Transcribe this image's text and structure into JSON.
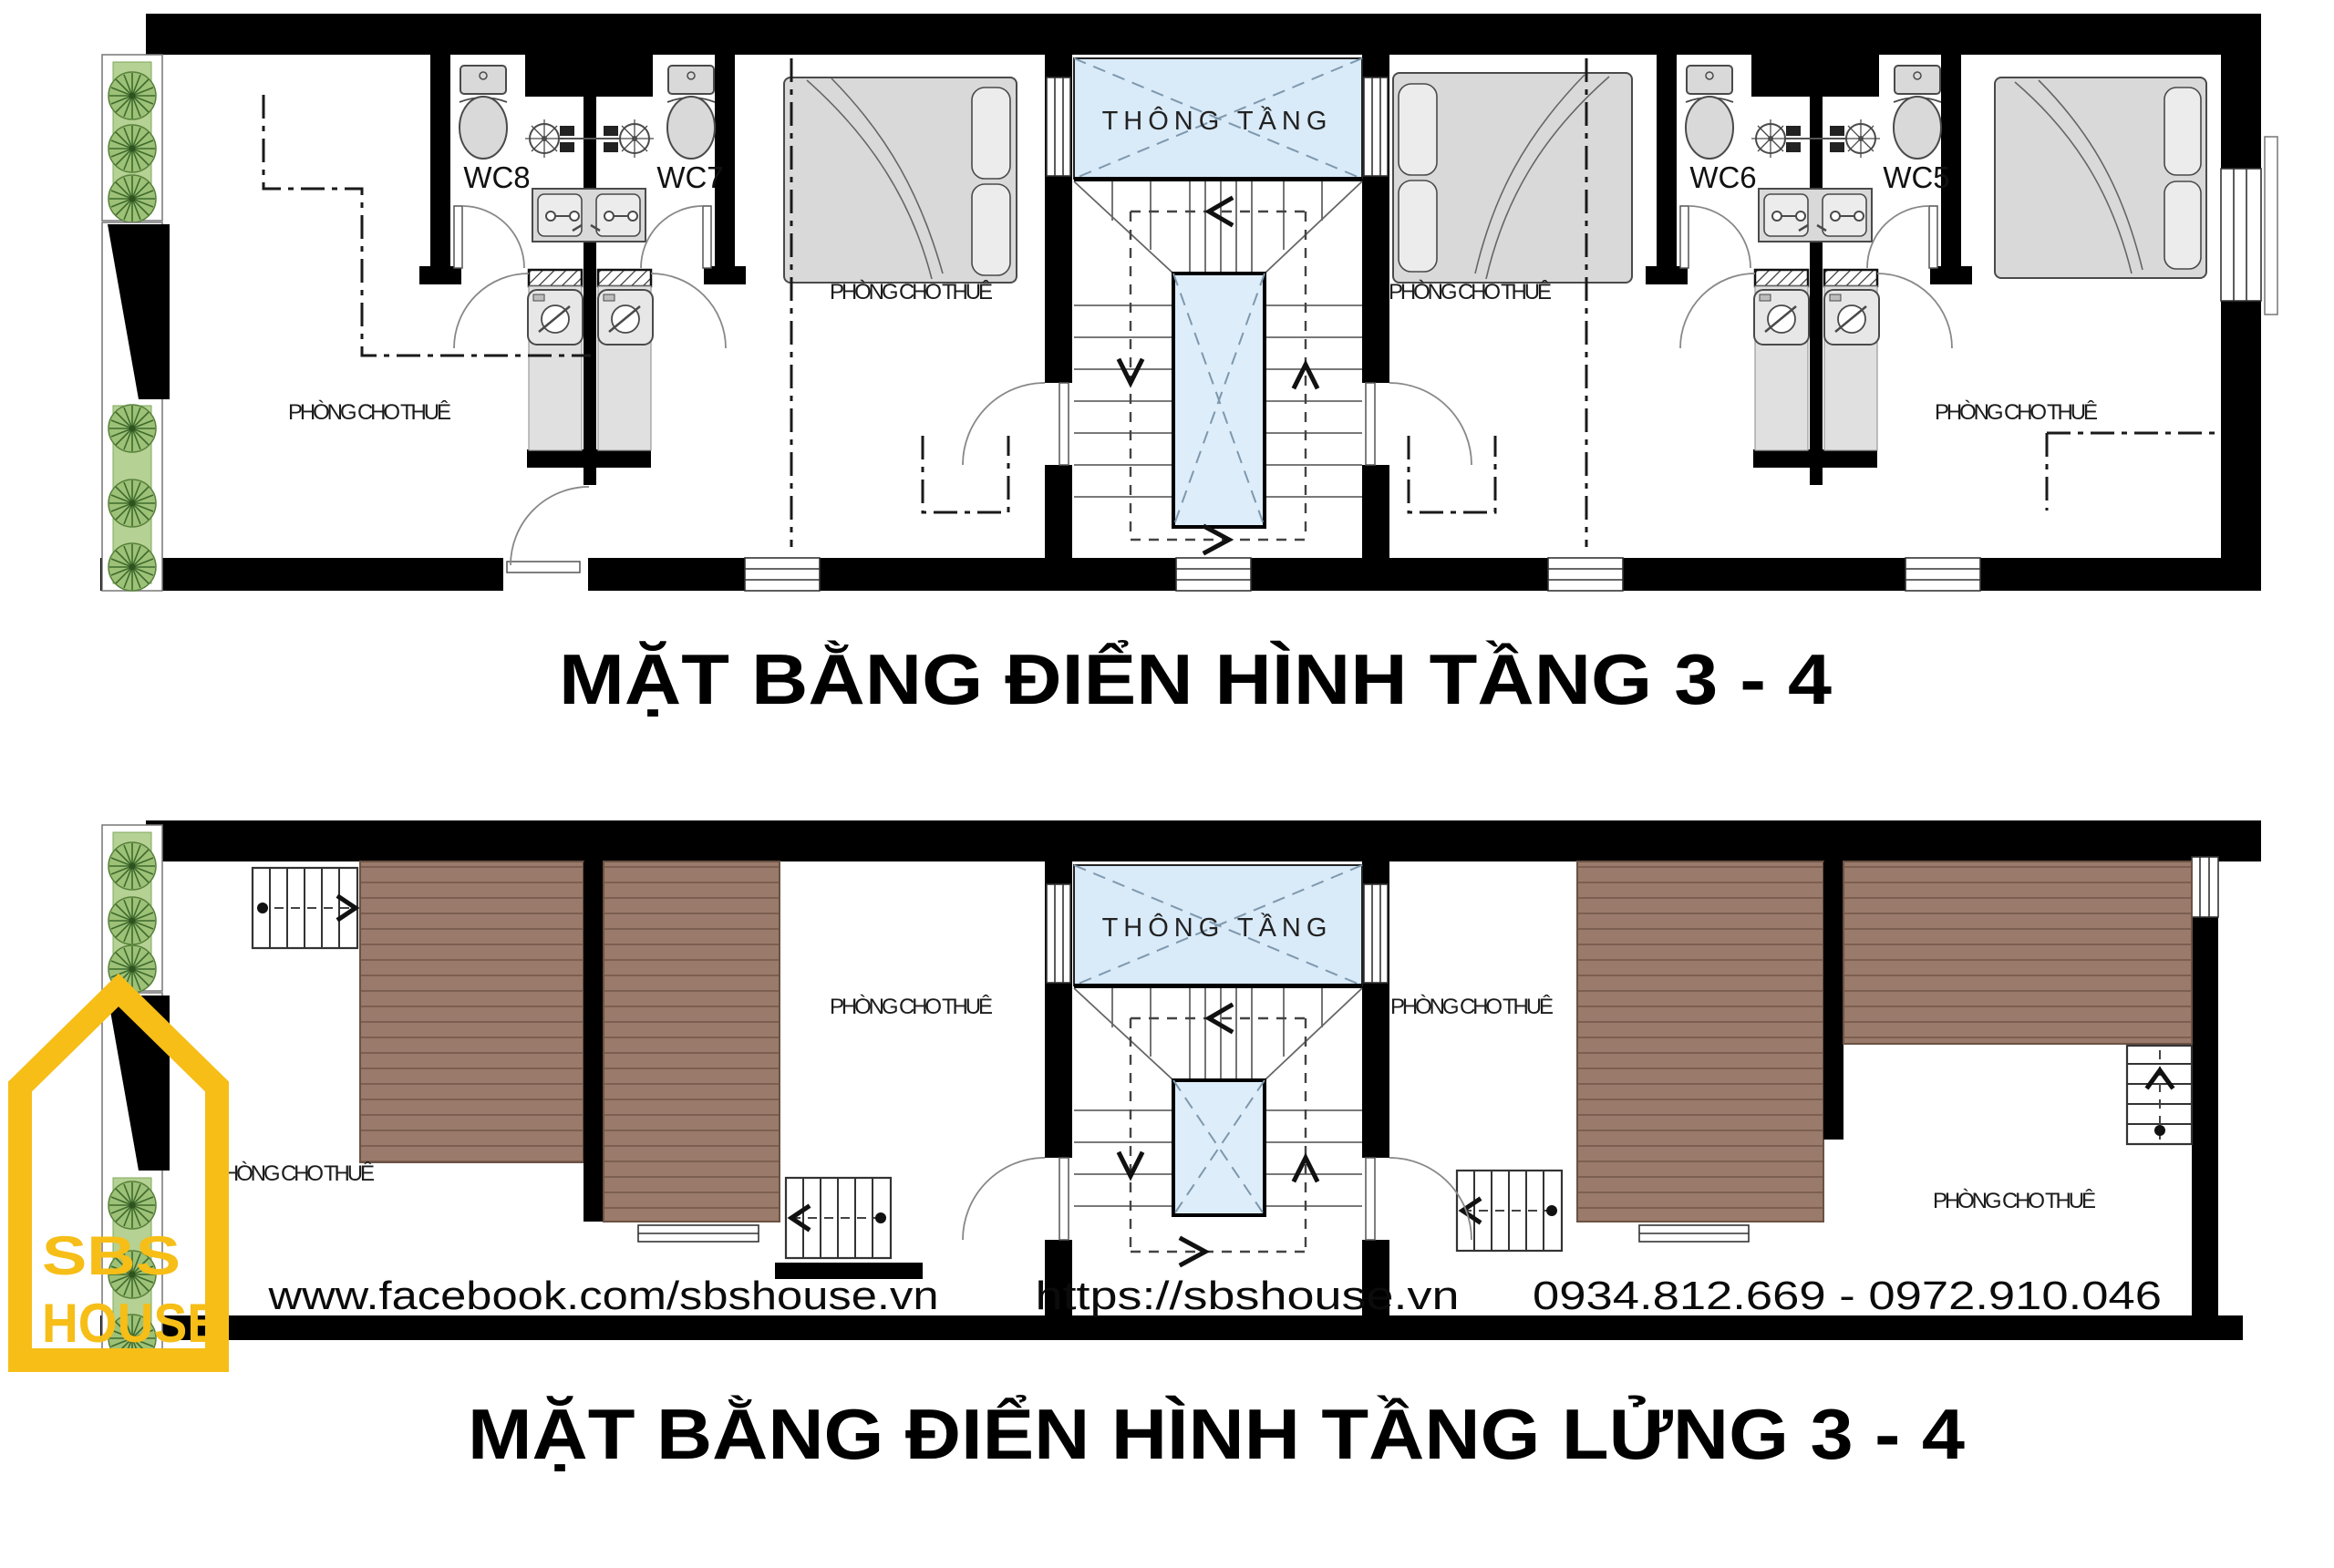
{
  "titles": {
    "plan1": "MẶT BẰNG ĐIỂN HÌNH TẦNG 3 - 4",
    "plan2": "MẶT BẰNG ĐIỂN HÌNH TẦNG LỬNG 3 - 4"
  },
  "labels": {
    "room": "PHÒNG CHO THUÊ",
    "void": "THÔNG TẦNG",
    "wc8": "WC8",
    "wc7": "WC7",
    "wc6": "WC6",
    "wc5": "WC5"
  },
  "footer": {
    "facebook": "www.facebook.com/sbshouse.vn",
    "website": "https://sbshouse.vn",
    "phones": "0934.812.669 - 0972.910.046"
  },
  "logo": {
    "line1": "SBS",
    "line2": "HOUSE"
  },
  "colors": {
    "wall": "#000000",
    "void_fill": "#d9eaf8",
    "deck_fill": "#9a7a6a",
    "plank_line": "#7c5f51",
    "plant_green": "#9dc177",
    "planter_green": "#b5d194",
    "logo_yellow": "#f6be17",
    "fixture_gray": "#d9d9d9"
  }
}
